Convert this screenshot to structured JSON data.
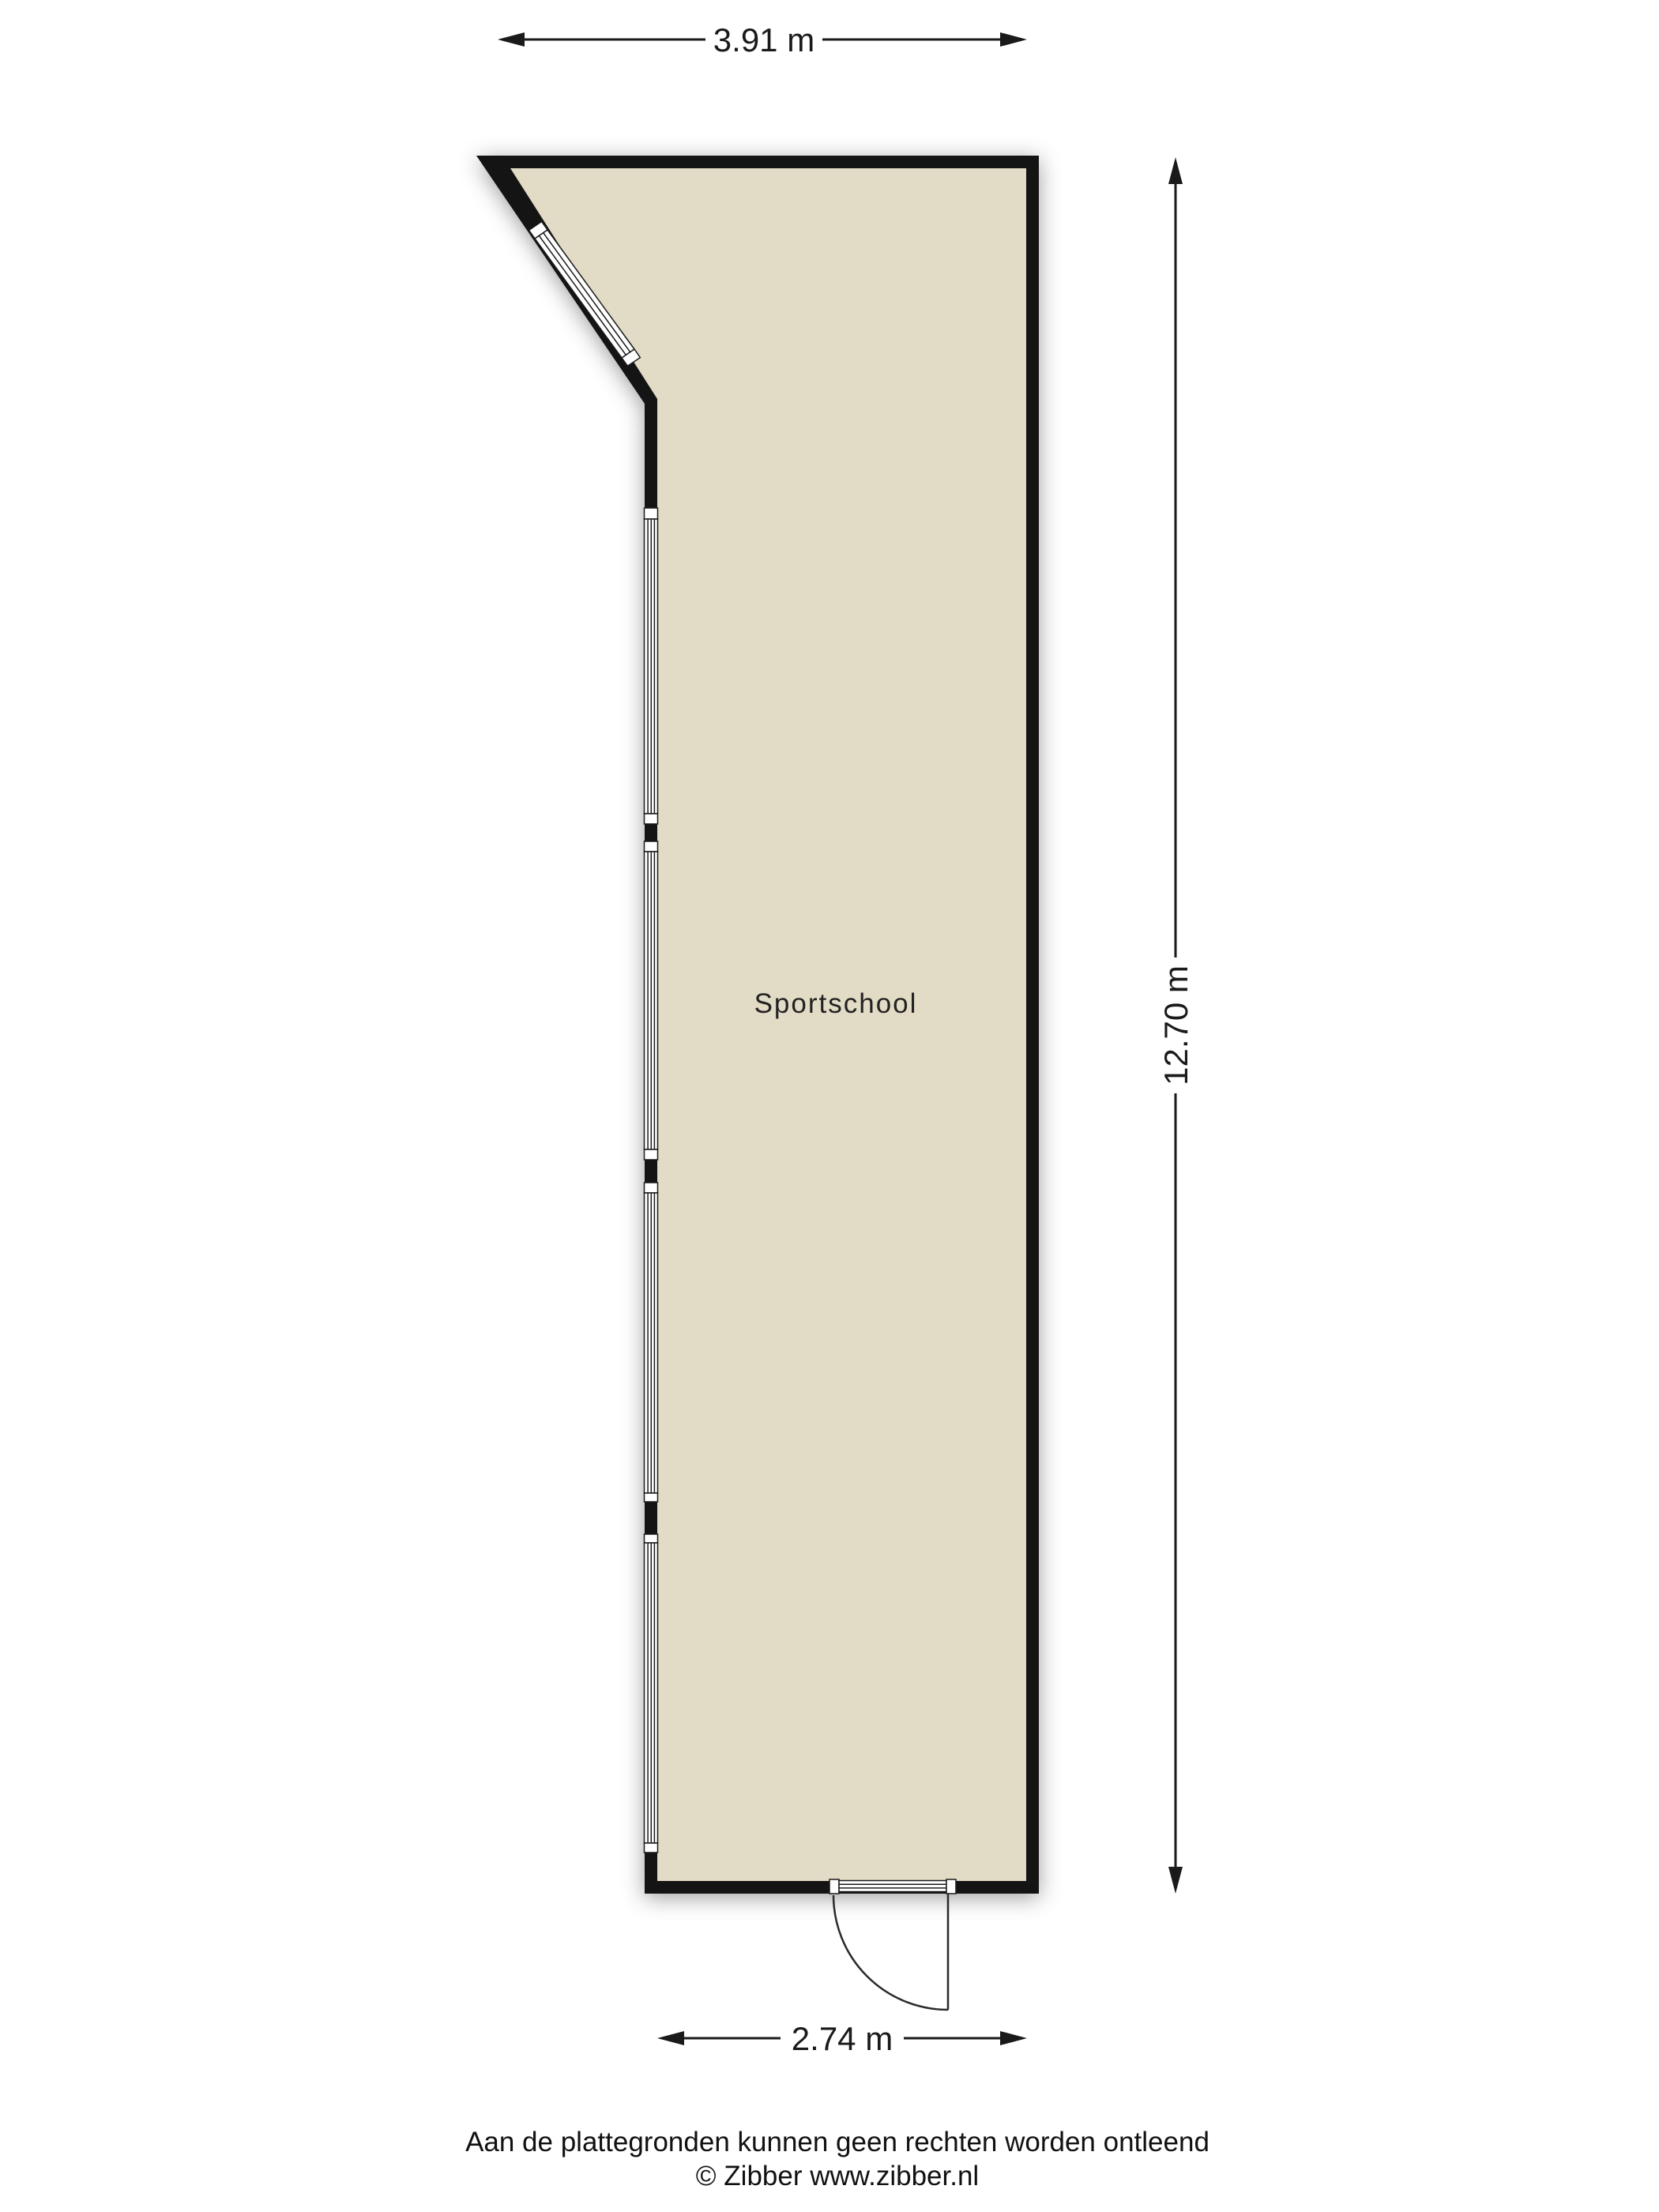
{
  "floorplan": {
    "room": {
      "label": "Sportschool"
    },
    "dimensions": {
      "top": "3.91 m",
      "right": "12.70 m",
      "bottom": "2.74 m"
    },
    "colors": {
      "wall": "#141414",
      "floor": "#e2dbc5",
      "background": "#ffffff"
    },
    "footer": {
      "disclaimer": "Aan de plattegronden kunnen geen rechten worden ontleend",
      "copyright": "© Zibber www.zibber.nl"
    }
  }
}
